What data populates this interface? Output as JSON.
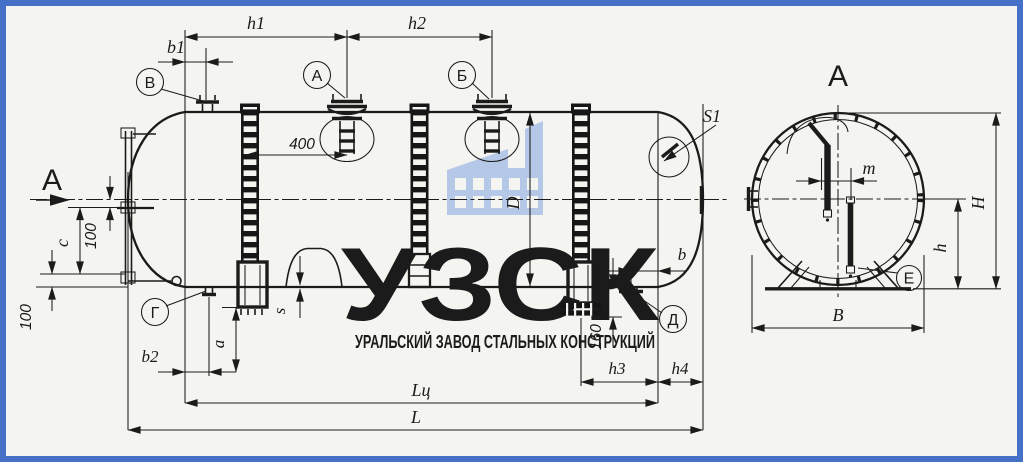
{
  "frame": {
    "color": "#4470c8"
  },
  "paper_color": "#f4f4f0",
  "line_color": "#1b1b1b",
  "watermark": {
    "logo_text": "УЗСК",
    "subtitle": "УРАЛЬСКИЙ ЗАВОД СТАЛЬНЫХ КОНСТРУКЦИЙ",
    "logo_color": "#c6cedb",
    "subtitle_color": "#7b96d0",
    "icon": "factory-icon",
    "icon_color": "#b6c8e8"
  },
  "view_labels": {
    "cut_arrow": "А",
    "section_title": "А"
  },
  "fittings": {
    "v": "В",
    "a": "А",
    "b": "Б",
    "g": "Г",
    "d": "Д",
    "e": "Е"
  },
  "dimensions": {
    "h1": "h1",
    "h2": "h2",
    "b1": "b1",
    "n400": "400",
    "D": "D",
    "S1": "S1",
    "b": "b",
    "n160": "160",
    "c": "c",
    "n100_upper": "100",
    "n100_lower": "100",
    "b2": "b2",
    "a": "a",
    "s": "s",
    "h3": "h3",
    "h4": "h4",
    "Lc": "Lц",
    "L": "L",
    "m": "m",
    "H": "H",
    "h": "h",
    "B": "B"
  }
}
